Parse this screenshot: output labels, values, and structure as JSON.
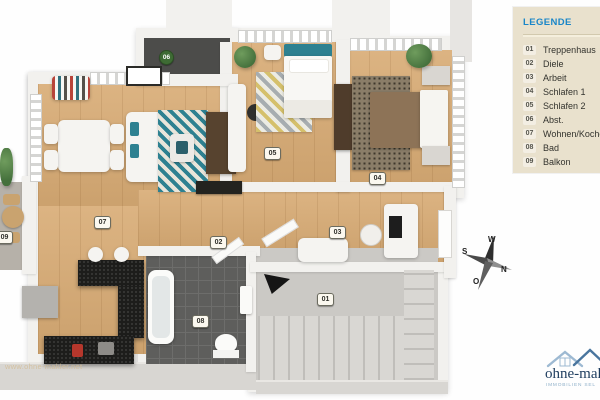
{
  "legend": {
    "title": "LEGENDE",
    "items": [
      {
        "num": "01",
        "label": "Treppenhaus"
      },
      {
        "num": "02",
        "label": "Diele"
      },
      {
        "num": "03",
        "label": "Arbeit"
      },
      {
        "num": "04",
        "label": "Schlafen 1"
      },
      {
        "num": "05",
        "label": "Schlafen 2"
      },
      {
        "num": "06",
        "label": "Abst."
      },
      {
        "num": "07",
        "label": "Wohnen/Kochen"
      },
      {
        "num": "08",
        "label": "Bad"
      },
      {
        "num": "09",
        "label": "Balkon"
      }
    ]
  },
  "compass": {
    "west": "W",
    "south": "S",
    "north": "N",
    "east": "O"
  },
  "branding": {
    "logo_text": "ohne-makler",
    "logo_tagline": "IMMOBILIEN SEL",
    "watermark": "www.ohne-makler.net"
  },
  "colors": {
    "accent_blue": "#1a86c8",
    "legend_bg": "#e9e1cd",
    "badge_green": "#3e6b34",
    "logo_navy": "#1d3c5e",
    "logo_blue": "#8fb0c9",
    "teal_accent": "#2e8191",
    "wood_floor": "#d8ab74",
    "tile_gray": "#5e5e5c"
  }
}
